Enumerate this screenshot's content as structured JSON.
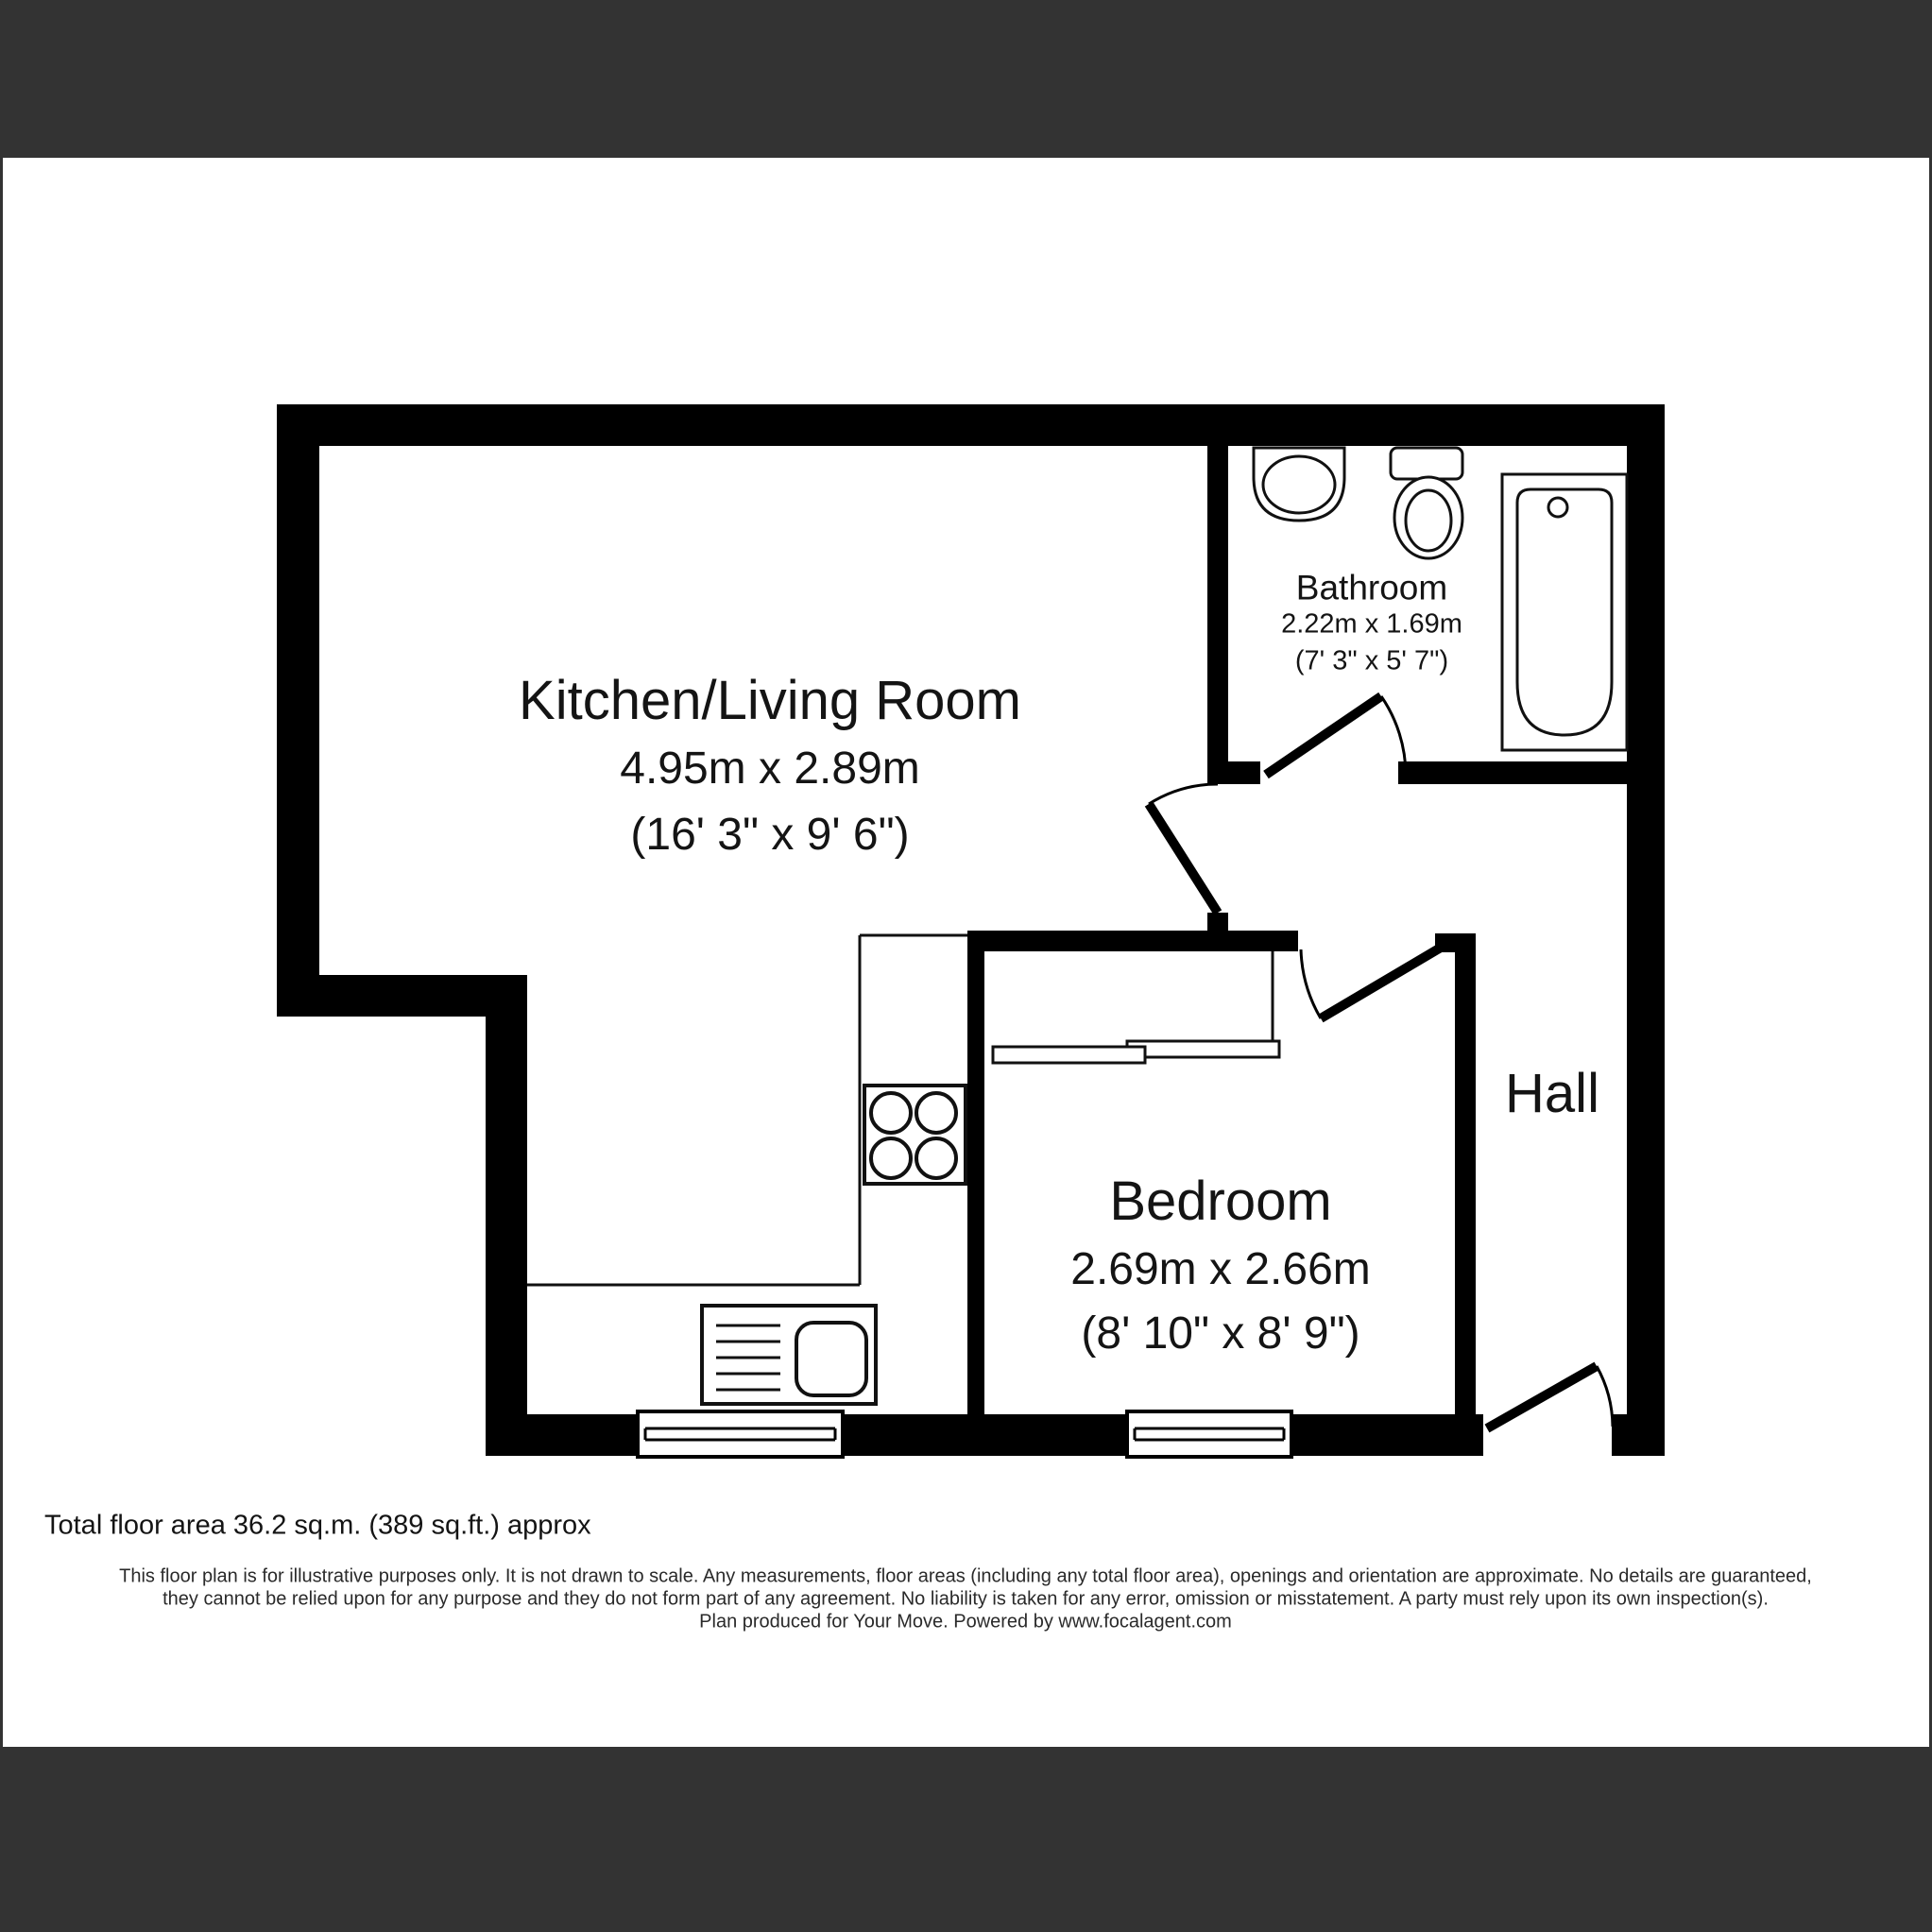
{
  "colors": {
    "background": "#333333",
    "paper": "#ffffff",
    "wall": "#000000",
    "line": "#111111",
    "text": "#141414"
  },
  "rooms": {
    "kitchen_living": {
      "name": "Kitchen/Living Room",
      "metric": "4.95m x 2.89m",
      "imperial": "(16' 3\" x 9' 6\")"
    },
    "bathroom": {
      "name": "Bathroom",
      "metric": "2.22m x 1.69m",
      "imperial": "(7' 3\" x 5' 7\")"
    },
    "bedroom": {
      "name": "Bedroom",
      "metric": "2.69m x 2.66m",
      "imperial": "(8' 10\" x 8' 9\")"
    },
    "hall": {
      "name": "Hall"
    }
  },
  "fixtures": {
    "bathroom": [
      "basin-icon",
      "toilet-icon",
      "bathtub-icon"
    ],
    "kitchen": [
      "hob-icon",
      "sink-drainer-icon",
      "counter-lines"
    ],
    "bedroom": [
      "wardrobe-icon"
    ],
    "window_count": 2,
    "door_count": 4
  },
  "footer": {
    "total_area": "Total floor area 36.2 sq.m. (389 sq.ft.) approx",
    "disclaimer_line1": "This floor plan is for illustrative purposes only. It is not drawn to scale. Any measurements, floor areas (including any total floor area), openings and orientation are approximate. No details are guaranteed,",
    "disclaimer_line2": "they cannot be relied upon for any purpose and they do not form part of any agreement. No liability is taken for any error, omission or misstatement. A party must rely upon its own inspection(s).",
    "disclaimer_line3": "Plan produced for Your Move. Powered by www.focalagent.com"
  }
}
